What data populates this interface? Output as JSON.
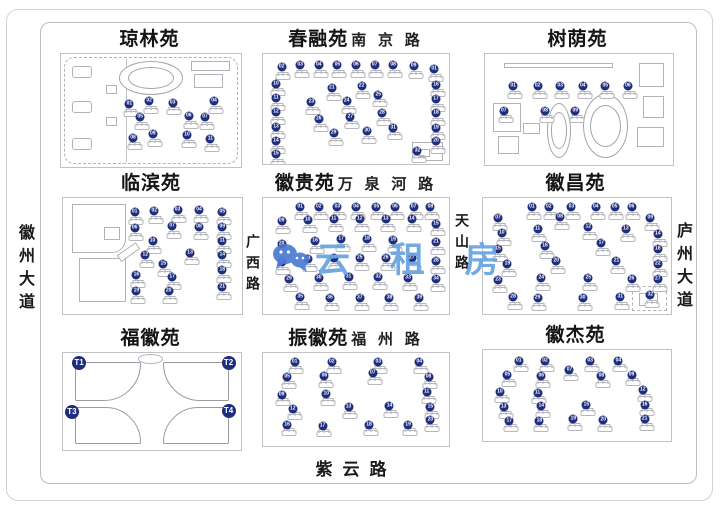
{
  "marker_color": "#1e2d7d",
  "watermark": {
    "text": "云 租 房",
    "icon": "wechat-icon",
    "color_text": "#66a3e0",
    "color_icon": "#4b7bd2"
  },
  "roads": {
    "left_avenue": "徽州大道",
    "guangxi_road": "广西路",
    "tianshan_road": "天山路",
    "right_avenue": "庐州大道",
    "bottom_road": "紫云路"
  },
  "marker_format_note": "markers are [label, x_percent, y_percent, big_flag]",
  "compounds": [
    {
      "id": "qionglin",
      "title": "琼林苑",
      "road": "",
      "markers": [
        [
          "01",
          38,
          44
        ],
        [
          "02",
          49,
          42
        ],
        [
          "03",
          62,
          43
        ],
        [
          "04",
          85,
          42
        ],
        [
          "05",
          44,
          56
        ],
        [
          "06",
          71,
          55
        ],
        [
          "07",
          80,
          56
        ],
        [
          "08",
          40,
          74
        ],
        [
          "09",
          51,
          71
        ],
        [
          "10",
          70,
          72
        ],
        [
          "11",
          83,
          75
        ]
      ]
    },
    {
      "id": "chunrong",
      "title": "春融苑",
      "road": "南 京 路",
      "markers": [
        [
          "01",
          92,
          14
        ],
        [
          "02",
          10,
          12
        ],
        [
          "03",
          20,
          10
        ],
        [
          "04",
          30,
          10
        ],
        [
          "05",
          40,
          10
        ],
        [
          "06",
          50,
          10
        ],
        [
          "07",
          60,
          10
        ],
        [
          "08",
          70,
          10
        ],
        [
          "09",
          81,
          11
        ],
        [
          "10",
          7,
          27
        ],
        [
          "11",
          7,
          40
        ],
        [
          "12",
          7,
          53
        ],
        [
          "13",
          7,
          66
        ],
        [
          "14",
          7,
          79
        ],
        [
          "15",
          7,
          91
        ],
        [
          "16",
          93,
          28
        ],
        [
          "17",
          93,
          41
        ],
        [
          "18",
          93,
          54
        ],
        [
          "19",
          93,
          67
        ],
        [
          "20",
          93,
          79
        ],
        [
          "21",
          37,
          31
        ],
        [
          "22",
          53,
          29
        ],
        [
          "23",
          26,
          44
        ],
        [
          "24",
          45,
          43
        ],
        [
          "25",
          62,
          37
        ],
        [
          "26",
          30,
          59
        ],
        [
          "27",
          47,
          57
        ],
        [
          "28",
          64,
          54
        ],
        [
          "29",
          38,
          72
        ],
        [
          "30",
          56,
          70
        ],
        [
          "31",
          70,
          67
        ],
        [
          "32",
          83,
          88
        ]
      ]
    },
    {
      "id": "shuyin",
      "title": "树荫苑",
      "road": "",
      "markers": [
        [
          "01",
          15,
          29
        ],
        [
          "02",
          28,
          29
        ],
        [
          "03",
          40,
          29
        ],
        [
          "04",
          52,
          29
        ],
        [
          "05",
          64,
          29
        ],
        [
          "06",
          76,
          29
        ],
        [
          "07",
          10,
          51
        ],
        [
          "08",
          32,
          51
        ],
        [
          "09",
          48,
          51
        ]
      ]
    },
    {
      "id": "linbin",
      "title": "临滨苑",
      "road": "",
      "markers": [
        [
          "01",
          40,
          12
        ],
        [
          "02",
          51,
          11
        ],
        [
          "03",
          64,
          10
        ],
        [
          "04",
          76,
          10
        ],
        [
          "05",
          89,
          12
        ],
        [
          "06",
          40,
          26
        ],
        [
          "07",
          61,
          24
        ],
        [
          "08",
          76,
          25
        ],
        [
          "09",
          89,
          25
        ],
        [
          "10",
          50,
          37
        ],
        [
          "11",
          89,
          37
        ],
        [
          "12",
          46,
          49
        ],
        [
          "13",
          71,
          47
        ],
        [
          "14",
          89,
          49
        ],
        [
          "15",
          56,
          57
        ],
        [
          "16",
          41,
          66
        ],
        [
          "17",
          61,
          68
        ],
        [
          "18",
          89,
          62
        ],
        [
          "19",
          41,
          80
        ],
        [
          "20",
          59,
          80
        ],
        [
          "21",
          89,
          77
        ]
      ]
    },
    {
      "id": "huigui",
      "title": "徽贵苑",
      "road": "万 泉 河 路",
      "markers": [
        [
          "01",
          20,
          8
        ],
        [
          "02",
          30,
          8
        ],
        [
          "03",
          40,
          8
        ],
        [
          "04",
          50,
          8
        ],
        [
          "05",
          61,
          8
        ],
        [
          "06",
          71,
          8
        ],
        [
          "07",
          81,
          8
        ],
        [
          "08",
          90,
          8
        ],
        [
          "09",
          10,
          20
        ],
        [
          "10",
          24,
          19
        ],
        [
          "11",
          38,
          18
        ],
        [
          "12",
          52,
          18
        ],
        [
          "13",
          66,
          18
        ],
        [
          "14",
          80,
          18
        ],
        [
          "15",
          93,
          22
        ],
        [
          "16",
          28,
          37
        ],
        [
          "17",
          42,
          35
        ],
        [
          "18",
          56,
          35
        ],
        [
          "19",
          70,
          36
        ],
        [
          "20",
          10,
          40
        ],
        [
          "21",
          93,
          38
        ],
        [
          "22",
          10,
          55
        ],
        [
          "23",
          24,
          53
        ],
        [
          "24",
          38,
          52
        ],
        [
          "25",
          52,
          52
        ],
        [
          "26",
          66,
          52
        ],
        [
          "27",
          80,
          52
        ],
        [
          "28",
          93,
          54
        ],
        [
          "29",
          14,
          70
        ],
        [
          "30",
          30,
          69
        ],
        [
          "31",
          46,
          68
        ],
        [
          "32",
          62,
          68
        ],
        [
          "33",
          78,
          69
        ],
        [
          "34",
          93,
          70
        ],
        [
          "35",
          20,
          85
        ],
        [
          "36",
          36,
          86
        ],
        [
          "37",
          52,
          86
        ],
        [
          "38",
          68,
          86
        ],
        [
          "39",
          84,
          86
        ]
      ]
    },
    {
      "id": "huichang",
      "title": "徽昌苑",
      "road": "",
      "markers": [
        [
          "01",
          26,
          8
        ],
        [
          "02",
          35,
          8
        ],
        [
          "03",
          47,
          8
        ],
        [
          "04",
          60,
          8
        ],
        [
          "05",
          70,
          8
        ],
        [
          "06",
          79,
          8
        ],
        [
          "07",
          8,
          17
        ],
        [
          "08",
          41,
          16
        ],
        [
          "09",
          89,
          17
        ],
        [
          "10",
          10,
          30
        ],
        [
          "11",
          29,
          27
        ],
        [
          "12",
          56,
          25
        ],
        [
          "13",
          76,
          27
        ],
        [
          "14",
          93,
          31
        ],
        [
          "15",
          8,
          44
        ],
        [
          "16",
          33,
          41
        ],
        [
          "17",
          63,
          39
        ],
        [
          "18",
          93,
          44
        ],
        [
          "19",
          13,
          57
        ],
        [
          "20",
          39,
          54
        ],
        [
          "21",
          71,
          54
        ],
        [
          "22",
          93,
          57
        ],
        [
          "23",
          8,
          71
        ],
        [
          "24",
          31,
          69
        ],
        [
          "25",
          56,
          69
        ],
        [
          "26",
          79,
          70
        ],
        [
          "27",
          93,
          70
        ],
        [
          "28",
          16,
          85
        ],
        [
          "29",
          29,
          86
        ],
        [
          "30",
          53,
          86
        ],
        [
          "31",
          73,
          85
        ],
        [
          "32",
          89,
          84
        ]
      ]
    },
    {
      "id": "fuhui",
      "title": "福徽苑",
      "road": "",
      "markers": [
        [
          "T1",
          9,
          10,
          1
        ],
        [
          "T2",
          93,
          10,
          1
        ],
        [
          "T3",
          5,
          61,
          1
        ],
        [
          "T4",
          93,
          60,
          1
        ]
      ]
    },
    {
      "id": "zhenhui",
      "title": "振徽苑",
      "road": "福 州 路",
      "markers": [
        [
          "01",
          17,
          10
        ],
        [
          "02",
          37,
          10
        ],
        [
          "03",
          62,
          10
        ],
        [
          "04",
          84,
          10
        ],
        [
          "05",
          13,
          26
        ],
        [
          "06",
          33,
          25
        ],
        [
          "07",
          59,
          22
        ],
        [
          "08",
          89,
          26
        ],
        [
          "09",
          10,
          45
        ],
        [
          "10",
          34,
          44
        ],
        [
          "11",
          88,
          42
        ],
        [
          "12",
          16,
          60
        ],
        [
          "13",
          46,
          58
        ],
        [
          "14",
          68,
          57
        ],
        [
          "15",
          90,
          58
        ],
        [
          "16",
          13,
          77
        ],
        [
          "17",
          32,
          78
        ],
        [
          "18",
          57,
          77
        ],
        [
          "19",
          78,
          77
        ],
        [
          "20",
          90,
          72
        ]
      ]
    },
    {
      "id": "huijie",
      "title": "徽杰苑",
      "road": "",
      "markers": [
        [
          "01",
          19,
          12
        ],
        [
          "02",
          33,
          12
        ],
        [
          "03",
          57,
          12
        ],
        [
          "04",
          72,
          12
        ],
        [
          "05",
          13,
          28
        ],
        [
          "06",
          31,
          29
        ],
        [
          "07",
          46,
          22
        ],
        [
          "08",
          63,
          29
        ],
        [
          "09",
          79,
          27
        ],
        [
          "10",
          9,
          46
        ],
        [
          "11",
          29,
          47
        ],
        [
          "12",
          85,
          44
        ],
        [
          "13",
          11,
          63
        ],
        [
          "14",
          31,
          62
        ],
        [
          "15",
          55,
          60
        ],
        [
          "16",
          86,
          60
        ],
        [
          "17",
          14,
          78
        ],
        [
          "18",
          30,
          78
        ],
        [
          "19",
          48,
          76
        ],
        [
          "20",
          64,
          77
        ],
        [
          "21",
          86,
          76
        ]
      ]
    }
  ]
}
